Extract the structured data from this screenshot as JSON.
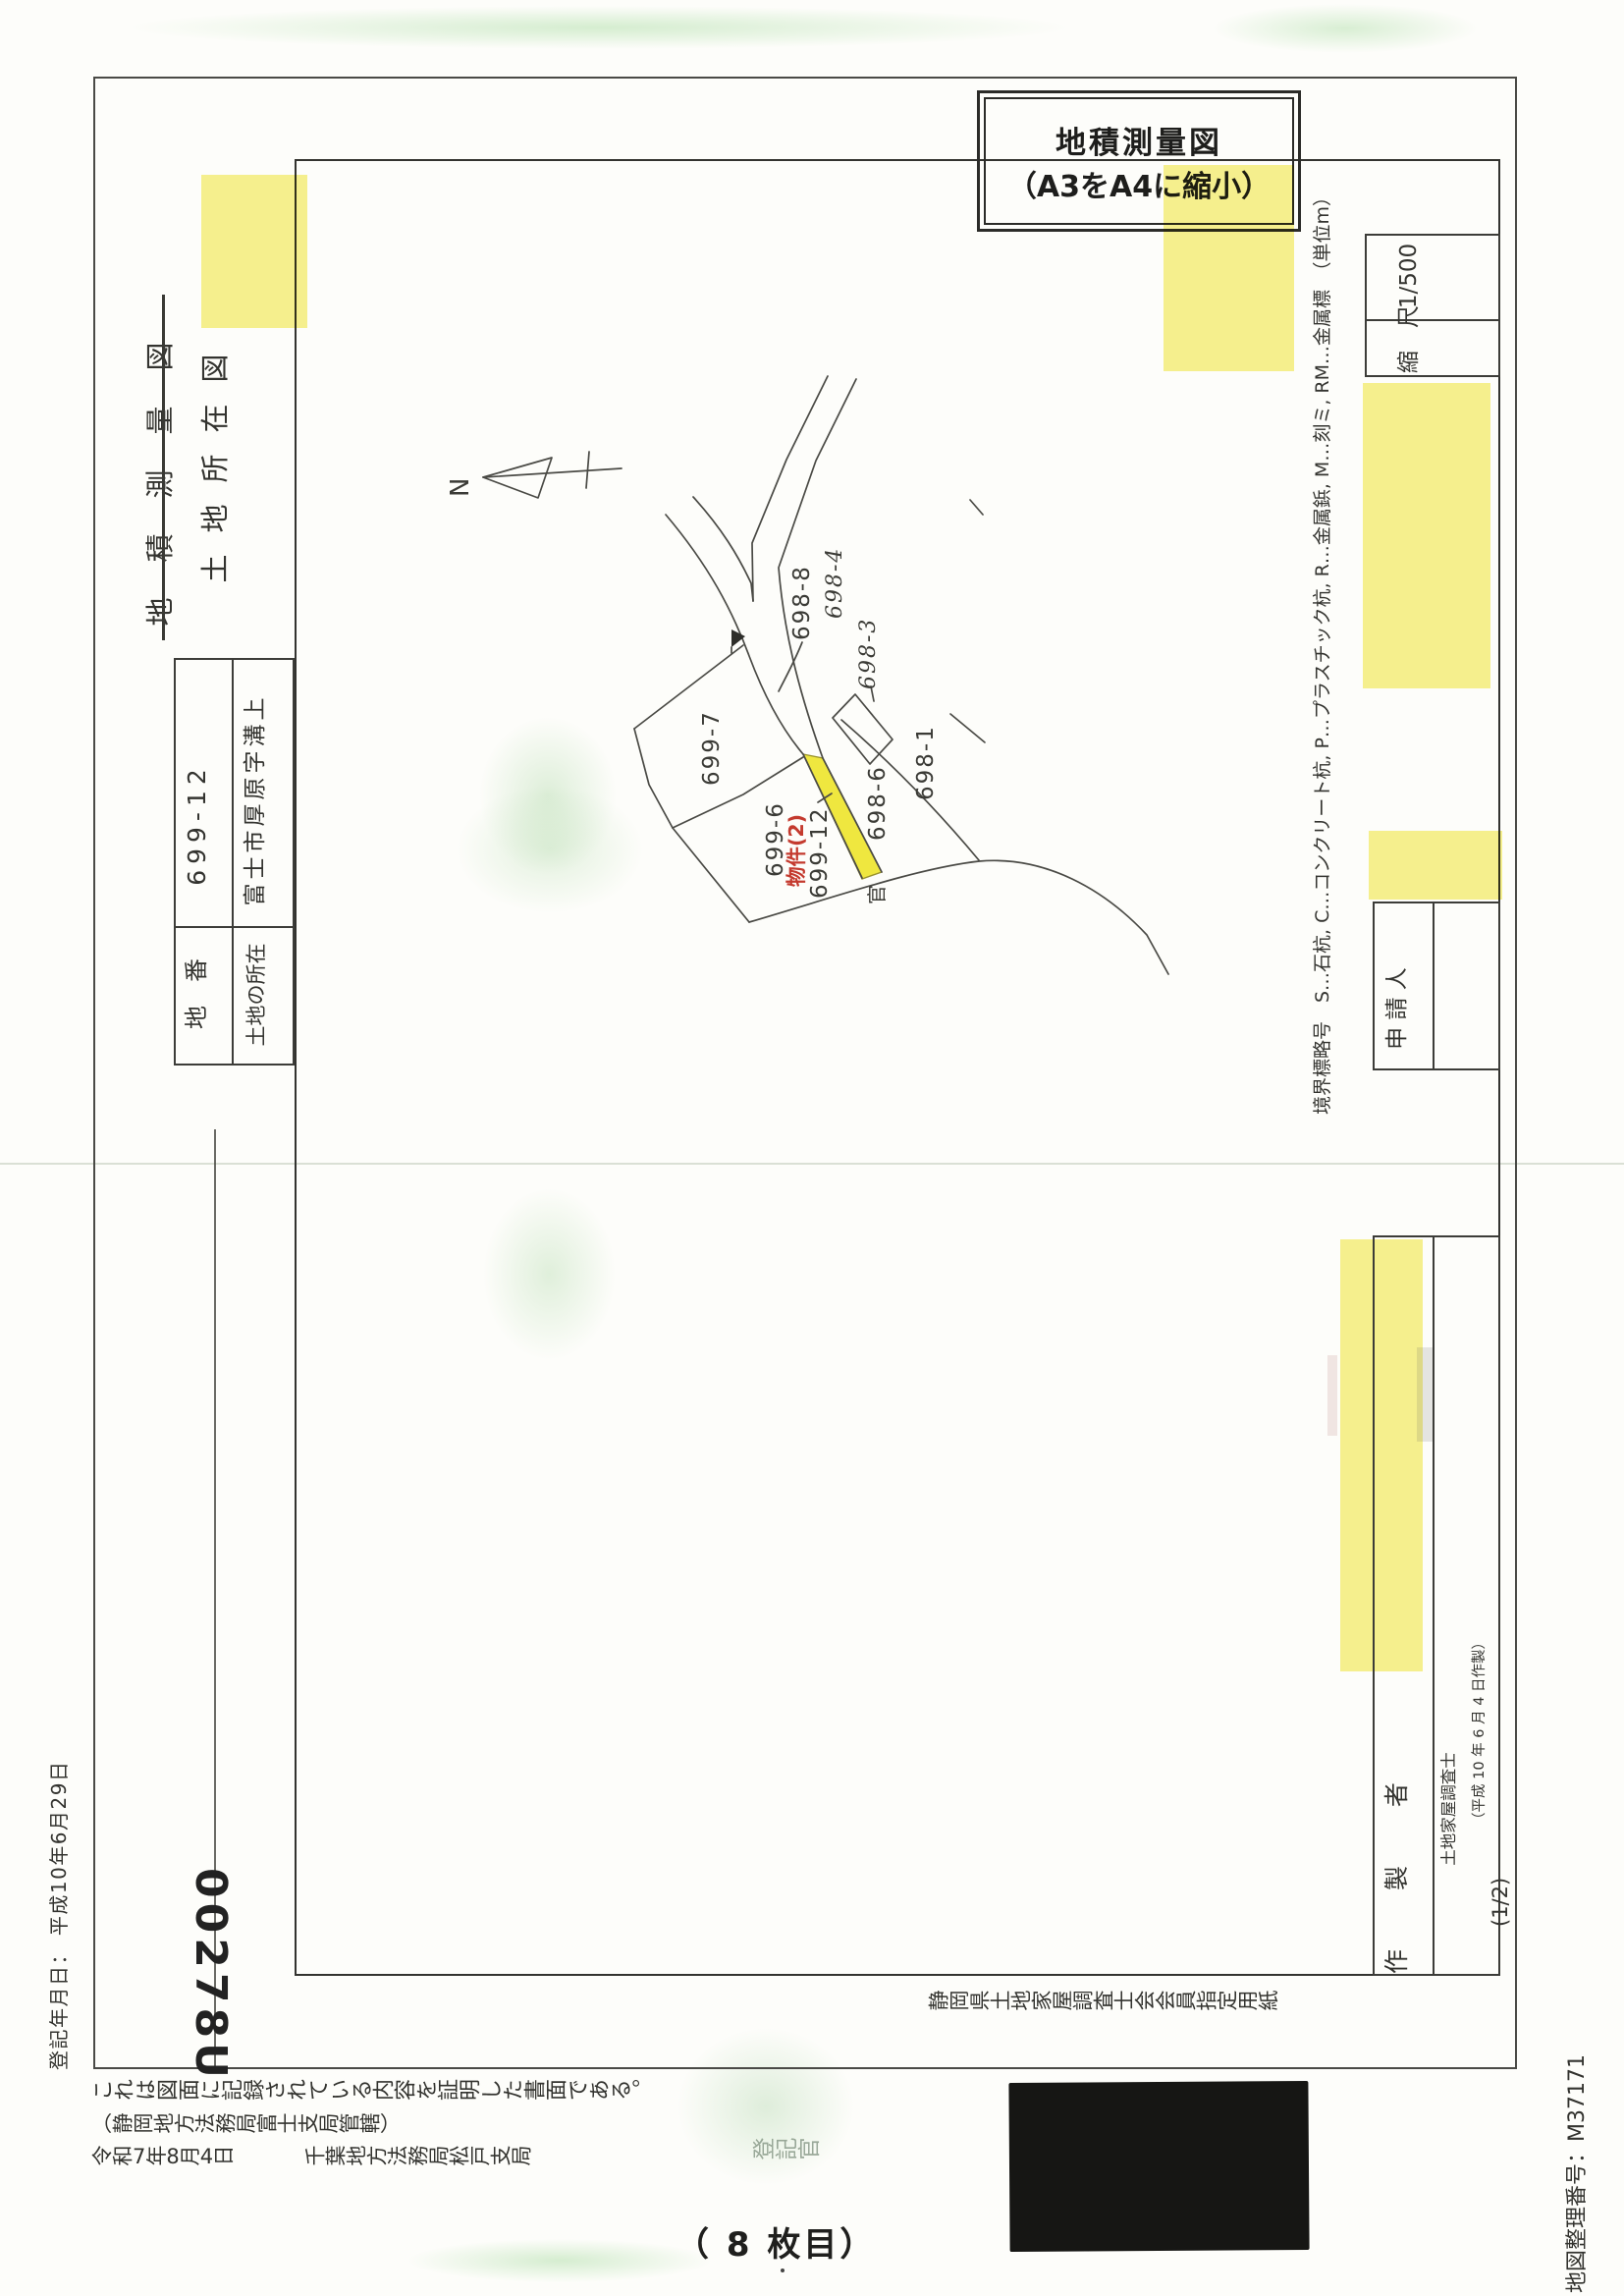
{
  "stamp": {
    "line1": "地積測量図",
    "line2": "（A3をA4に縮小）"
  },
  "header": {
    "title_struck": "地積測量図",
    "title_plain": "土地所在図",
    "registration_date": "登記年月日： 平成10年6月29日",
    "serial_number": "00278U"
  },
  "land_table": {
    "parcel_label": "地　番",
    "parcel_value": "699-12",
    "location_label": "土地の所在",
    "location_value": "富士市厚原字溝上"
  },
  "map": {
    "north_label": "N",
    "parcels": {
      "p699_7": "699-7",
      "p699_6": "699-6",
      "p699_12": "699-12",
      "p698_6": "698-6",
      "p698_1": "698-1",
      "p698_8": "698-8",
      "p698_4": "698-4",
      "p698_3": "698-3",
      "kan": "官"
    },
    "subject_annotation": "物件(2)"
  },
  "form": {
    "legend": "境界標略号　S…石杭, C…コンクリート杭, P…プラスチック杭, R…金属鋲, M…刻ミ, RM…金属標　（単位m）",
    "scale_label": "縮　尺",
    "scale_value": "1/500",
    "applicant_label": "申 請 人",
    "preparer_label": "作 製 者",
    "preparer_title": "土地家屋調査士",
    "preparer_date": "（平成 10 年 6 月 4 日作製）",
    "paper_note": "静岡県土地家屋調査士会会員指定用紙"
  },
  "footer": {
    "certify_line1": "これは図面に記録されている内容を証明した書面である。",
    "certify_line2": "（静岡地方法務局富士支局管轄）",
    "certify_date": "令和7年8月4日",
    "certify_office": "千葉地方法務局松戸支局",
    "registrar": "登記官",
    "page_note": "（ 8 枚目）",
    "map_number": "地図整理番号：M37171",
    "page_fraction": "(1/2)"
  },
  "colors": {
    "highlight": "#f6ef7d",
    "strip": "#efe73f",
    "annotation_red": "#c43a2e",
    "line": "#4a4a45"
  }
}
